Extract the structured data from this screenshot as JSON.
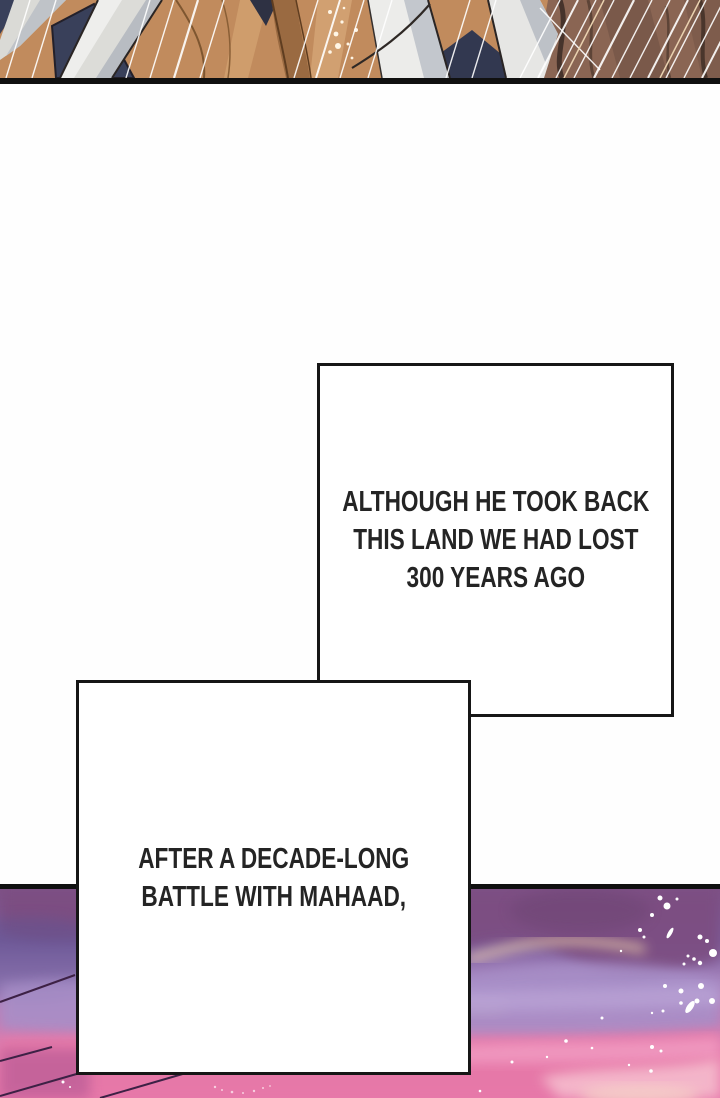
{
  "page": {
    "kind": "webtoon comic page",
    "background_color": "#fefefe",
    "panel_border_color": "#101010"
  },
  "narration_boxes": [
    {
      "lines": [
        "ALTHOUGH HE TOOK BACK",
        "THIS LAND WE HAD LOST",
        "300 YEARS AGO"
      ]
    },
    {
      "lines": [
        "AFTER A DECADE-LONG",
        "BATTLE WITH MAHAAD,"
      ]
    }
  ],
  "artwork": {
    "top_panel": {
      "subject": "close-up of tan hair strands, white fabric and navy clothing crossed by white speed lines",
      "palette": [
        "#c18b5d",
        "#8a6553",
        "#39405a",
        "#dcdcd8",
        "#ffffff"
      ]
    },
    "bottom_panel": {
      "subject": "purple and pink dusk sky with layered clouds, dark wisp lines and white paint-splatter sparkles",
      "palette": [
        "#7f5287",
        "#6f5590",
        "#a78fc8",
        "#e678a8",
        "#f5bccd",
        "#ffffff"
      ]
    }
  }
}
